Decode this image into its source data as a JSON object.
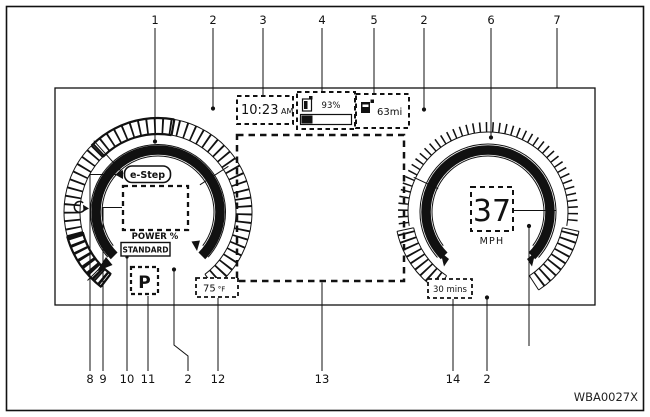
{
  "figure": {
    "code": "WBA0027X"
  },
  "callouts": {
    "top": [
      "1",
      "2",
      "3",
      "4",
      "5",
      "2",
      "6",
      "7"
    ],
    "bottom": [
      "8",
      "9",
      "10",
      "11",
      "2",
      "12",
      "13",
      "14",
      "2"
    ]
  },
  "display": {
    "clock": {
      "time": "10:23",
      "period": "AM"
    },
    "battery_charge": {
      "percent": "93%",
      "icon": "battery-icon"
    },
    "driving_range": {
      "value": "63mi",
      "icon": "charging-station-icon"
    },
    "power_meter": {
      "badge": "e-Step",
      "label": "POWER %",
      "icon": "regen-arrow-icon"
    },
    "drive_mode": {
      "value": "STANDARD"
    },
    "shift_position": {
      "value": "P"
    },
    "outside_temperature": {
      "value": "75",
      "unit": "°F"
    },
    "speedometer": {
      "value": "37",
      "unit": "MPH"
    },
    "charging_time": {
      "value": "30 mins"
    }
  }
}
